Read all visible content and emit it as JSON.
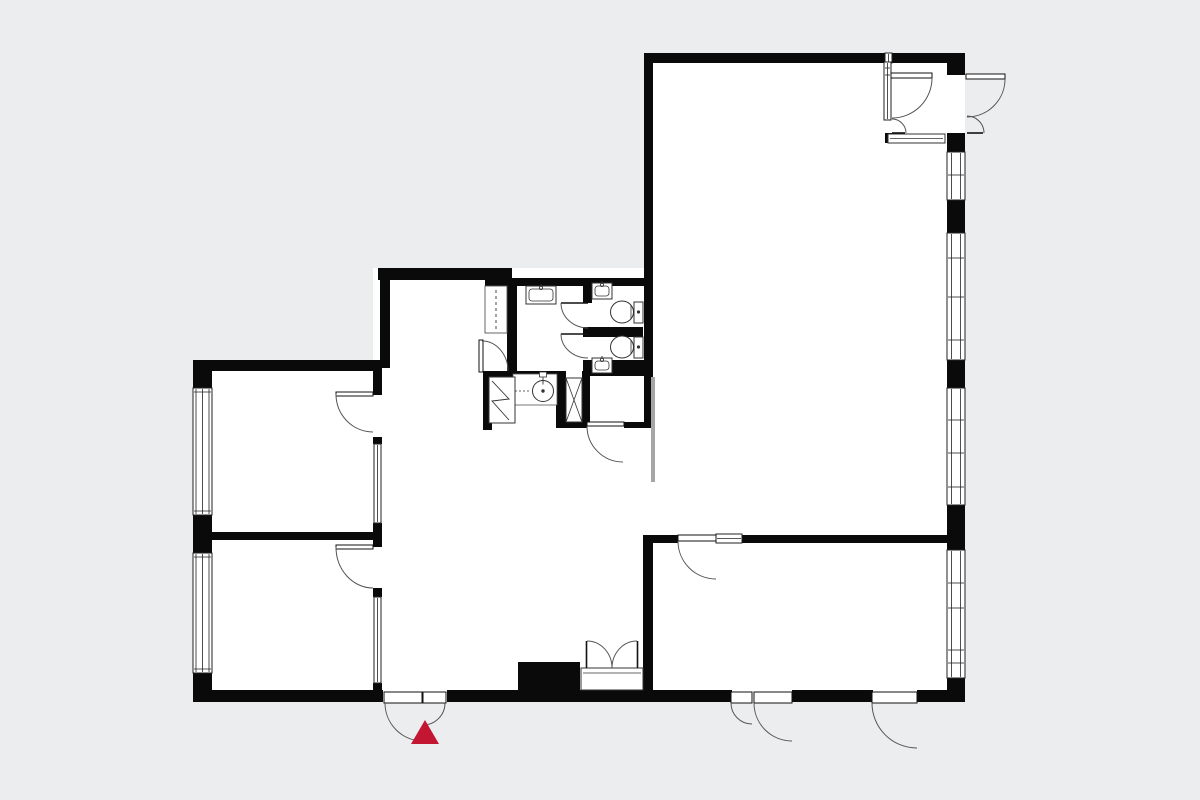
{
  "colors": {
    "background": "#ecedee",
    "floor": "#ffffff",
    "wall": "#0a0a0a",
    "outline": "#222222",
    "thin": "#555555",
    "arc": "#555555",
    "fixture": "#333333",
    "sliding_panel": "#a6a6a6",
    "accent_red": "#c31632"
  },
  "plan": {
    "floors": [
      {
        "n": "floor-main-room",
        "r": [
          644,
          53,
          321,
          649
        ]
      },
      {
        "n": "floor-middle-zone",
        "r": [
          373,
          268,
          280,
          434
        ]
      },
      {
        "n": "floor-left-rooms",
        "r": [
          193,
          360,
          189,
          342
        ]
      }
    ],
    "walls": [
      {
        "n": "wall-top-main-left",
        "r": [
          644,
          53,
          241,
          10
        ]
      },
      {
        "n": "wall-top-main-right",
        "r": [
          892,
          53,
          73,
          10
        ]
      },
      {
        "n": "wall-main-left",
        "r": [
          644,
          53,
          9,
          375
        ]
      },
      {
        "n": "wall-right-seg-1",
        "r": [
          947,
          53,
          18,
          22
        ]
      },
      {
        "n": "wall-right-seg-2",
        "r": [
          947,
          133,
          18,
          19
        ]
      },
      {
        "n": "wall-right-seg-3",
        "r": [
          947,
          200,
          18,
          33
        ]
      },
      {
        "n": "wall-right-seg-4",
        "r": [
          947,
          360,
          18,
          28
        ]
      },
      {
        "n": "wall-right-seg-5",
        "r": [
          947,
          505,
          18,
          45
        ]
      },
      {
        "n": "wall-right-seg-6",
        "r": [
          947,
          678,
          18,
          24
        ]
      },
      {
        "n": "wall-dining-top-left",
        "r": [
          643,
          535,
          35,
          8
        ]
      },
      {
        "n": "wall-dining-top-right",
        "r": [
          740,
          535,
          207,
          8
        ]
      },
      {
        "n": "wall-dining-left",
        "r": [
          643,
          543,
          10,
          147
        ]
      },
      {
        "n": "wall-bottom-seg-1",
        "r": [
          643,
          690,
          89,
          12
        ]
      },
      {
        "n": "wall-bottom-seg-2",
        "r": [
          792,
          690,
          81,
          12
        ]
      },
      {
        "n": "wall-bottom-seg-3",
        "r": [
          917,
          690,
          48,
          12
        ]
      },
      {
        "n": "wall-vestibule-nub",
        "r": [
          885,
          133,
          7,
          10
        ]
      },
      {
        "n": "wall-middle-top",
        "r": [
          378,
          268,
          134,
          12
        ]
      },
      {
        "n": "wall-middle-top-jog",
        "r": [
          485,
          268,
          27,
          18
        ]
      },
      {
        "n": "wall-bath-top-thin",
        "r": [
          505,
          278,
          148,
          8
        ]
      },
      {
        "n": "wall-middle-left-upper",
        "r": [
          380,
          268,
          10,
          100
        ]
      },
      {
        "n": "wall-bath1-left",
        "r": [
          507,
          286,
          10,
          85
        ]
      },
      {
        "n": "wall-wc-left-upper",
        "r": [
          583,
          280,
          9,
          23
        ]
      },
      {
        "n": "wall-wc-divider",
        "r": [
          583,
          327,
          60,
          10
        ]
      },
      {
        "n": "wall-below-wc",
        "r": [
          583,
          360,
          70,
          16
        ]
      },
      {
        "n": "wall-bath1-bottom",
        "r": [
          483,
          371,
          75,
          6
        ]
      },
      {
        "n": "wall-utility-left",
        "r": [
          483,
          371,
          9,
          59
        ]
      },
      {
        "n": "wall-shaft-left",
        "r": [
          556,
          371,
          10,
          57
        ]
      },
      {
        "n": "wall-shaft-right",
        "r": [
          582,
          371,
          8,
          51
        ]
      },
      {
        "n": "wall-hall-bottom-left",
        "r": [
          556,
          422,
          31,
          6
        ]
      },
      {
        "n": "wall-hall-bottom-right",
        "r": [
          624,
          422,
          29,
          6
        ]
      },
      {
        "n": "wall-bottom-middle",
        "r": [
          447,
          690,
          196,
          12
        ]
      },
      {
        "n": "wall-entrance-jamb",
        "r": [
          373,
          690,
          10,
          12
        ]
      },
      {
        "n": "chimney-block",
        "r": [
          518,
          662,
          62,
          28
        ]
      },
      {
        "n": "wall-leftrooms-top",
        "r": [
          193,
          360,
          189,
          11
        ]
      },
      {
        "n": "wall-leftrooms-divider",
        "r": [
          193,
          532,
          189,
          8
        ]
      },
      {
        "n": "wall-leftrooms-bottom",
        "r": [
          193,
          690,
          189,
          12
        ]
      },
      {
        "n": "wall-left-seg-1",
        "r": [
          193,
          360,
          19,
          28
        ]
      },
      {
        "n": "wall-left-seg-2",
        "r": [
          193,
          515,
          19,
          38
        ]
      },
      {
        "n": "wall-left-seg-3",
        "r": [
          193,
          673,
          19,
          29
        ]
      },
      {
        "n": "wall-leftrooms-right-1",
        "r": [
          373,
          371,
          9,
          24
        ]
      },
      {
        "n": "wall-leftrooms-right-2",
        "r": [
          373,
          437,
          9,
          7
        ]
      },
      {
        "n": "wall-leftrooms-right-3",
        "r": [
          373,
          523,
          9,
          24
        ]
      },
      {
        "n": "wall-leftrooms-right-4",
        "r": [
          373,
          588,
          9,
          9
        ]
      },
      {
        "n": "wall-leftrooms-right-5",
        "r": [
          373,
          683,
          9,
          19
        ]
      }
    ],
    "windows": [
      {
        "n": "window-left-top",
        "r": [
          193,
          388,
          19,
          127
        ],
        "v": [
          3,
          9.5,
          16
        ],
        "h": [
          392,
          511
        ]
      },
      {
        "n": "window-left-bottom",
        "r": [
          193,
          553,
          19,
          120
        ],
        "v": [
          3,
          9.5,
          16
        ],
        "h": [
          557,
          669
        ]
      },
      {
        "n": "window-right-1",
        "r": [
          947,
          152,
          18,
          48
        ],
        "v": [
          4.5,
          13.5
        ],
        "h": [
          175
        ]
      },
      {
        "n": "window-right-2",
        "r": [
          947,
          233,
          18,
          127
        ],
        "v": [
          4.5,
          13.5
        ],
        "h": [
          258,
          297,
          340
        ]
      },
      {
        "n": "window-right-3",
        "r": [
          947,
          388,
          18,
          117
        ],
        "v": [
          4.5,
          13.5
        ],
        "h": [
          420,
          453,
          487
        ]
      },
      {
        "n": "window-right-4",
        "r": [
          947,
          550,
          18,
          128
        ],
        "v": [
          4.5,
          13.5
        ],
        "h": [
          583,
          608,
          650,
          663
        ]
      },
      {
        "n": "window-transom-dining",
        "r": [
          716,
          534,
          26,
          9
        ],
        "v": [],
        "h": [
          538.5
        ]
      },
      {
        "n": "window-top-sliver",
        "r": [
          885,
          53,
          7,
          10
        ],
        "v": [
          3.5
        ],
        "h": []
      },
      {
        "n": "partition-glazed-top",
        "r": [
          374,
          444,
          7,
          79
        ],
        "v": [
          3.5
        ],
        "h": []
      },
      {
        "n": "partition-glazed-bottom",
        "r": [
          374,
          597,
          7,
          86
        ],
        "v": [
          3.5
        ],
        "h": []
      },
      {
        "n": "partition-vestibule",
        "r": [
          884,
          62,
          7,
          58
        ],
        "v": [
          3.5
        ],
        "h": [
          68,
          75
        ]
      }
    ],
    "doors": [
      {
        "n": "door-main-entrance-big",
        "leaf": {
          "rect": [
            384,
            692,
            38,
            11
          ]
        },
        "arc": "M385,703 A38,38 0 0 0 423,741"
      },
      {
        "n": "door-main-entrance-small",
        "leaf": {
          "rect": [
            423,
            692,
            23,
            11
          ]
        },
        "arc": "M445,703 A22,22 0 0 1 423,725"
      },
      {
        "n": "door-terrace1-small",
        "leaf": {
          "rect": [
            731,
            692,
            21,
            11
          ]
        },
        "arc": "M731,703 A21,21 0 0 0 752,724"
      },
      {
        "n": "door-terrace1-big",
        "leaf": {
          "rect": [
            754,
            692,
            38,
            11
          ]
        },
        "arc": "M754,703 A38,38 0 0 0 792,741"
      },
      {
        "n": "door-terrace2",
        "leaf": {
          "rect": [
            872,
            692,
            45,
            11
          ]
        },
        "arc": "M872,703 A45,45 0 0 0 917,748"
      },
      {
        "n": "door-side-entrance-big",
        "leaf": {
          "rect": [
            966,
            74,
            39,
            5
          ]
        },
        "arc": "M1005,79 A38,38 0 0 1 967,117"
      },
      {
        "n": "door-side-entrance-small",
        "leaf": {
          "line": [
            967,
            133,
            983,
            133
          ]
        },
        "arc": "M984,133 A17,17 0 0 0 967,116"
      },
      {
        "n": "door-vestibule-big",
        "leaf": {
          "rect": [
            891,
            73,
            41,
            5
          ]
        },
        "arc": "M932,78 A40,40 0 0 1 892,118"
      },
      {
        "n": "door-vestibule-small",
        "leaf": {
          "line": [
            892,
            133,
            905,
            133
          ]
        },
        "arc": "M906,133 A14,14 0 0 0 892,119"
      },
      {
        "n": "door-left-room-top",
        "leaf": {
          "rect": [
            336,
            392,
            37,
            4
          ]
        },
        "arc": "M336,394 A37,38 0 0 0 373,432"
      },
      {
        "n": "door-left-room-bottom",
        "leaf": {
          "rect": [
            336,
            545,
            37,
            4
          ]
        },
        "arc": "M336,547 A37,41 0 0 0 373,588"
      },
      {
        "n": "door-utility",
        "leaf": {
          "rect": [
            479,
            340,
            4,
            32
          ]
        },
        "arc": "M482,341 A26,30 0 0 1 508,371"
      },
      {
        "n": "door-wc1",
        "leaf": {
          "line": [
            561,
            303,
            588,
            303
          ]
        },
        "arc": "M561,303 A27,25 0 0 0 588,328"
      },
      {
        "n": "door-wc2",
        "leaf": {
          "line": [
            561,
            334,
            588,
            334
          ]
        },
        "arc": "M561,334 A27,24 0 0 0 588,358"
      },
      {
        "n": "door-hall",
        "leaf": {
          "rect": [
            587,
            422,
            37,
            4
          ]
        },
        "arc": "M587,426 A36,36 0 0 0 623,462"
      },
      {
        "n": "door-dining",
        "leaf": {
          "rect": [
            678,
            535,
            38,
            6
          ]
        },
        "arc": "M678,541 A38,38 0 0 0 716,579"
      },
      {
        "n": "door-cupboard-left",
        "leaf": {
          "line": [
            586.5,
            641,
            586.5,
            668
          ]
        },
        "arc": "M587,641 A25,27 0 0 1 612,668"
      },
      {
        "n": "door-cupboard-right",
        "leaf": {
          "line": [
            637.5,
            641,
            637.5,
            668
          ]
        },
        "arc": "M637,641 A25,27 0 0 0 612,668"
      }
    ],
    "fixtures": [
      {
        "t": "toilet",
        "n": "toilet-1",
        "bowl": [
          622,
          312,
          11.5,
          11
        ],
        "tank": [
          634,
          302,
          9,
          21
        ],
        "chord": [
          631,
          305,
          631,
          319
        ],
        "dot": [
          638.5,
          312
        ]
      },
      {
        "t": "toilet",
        "n": "toilet-2",
        "bowl": [
          622,
          347,
          11.5,
          11
        ],
        "tank": [
          634,
          337,
          9,
          21
        ],
        "chord": [
          631,
          340,
          631,
          354
        ],
        "dot": [
          638.5,
          347
        ]
      },
      {
        "t": "sink",
        "n": "sink-wc1",
        "outer": [
          592,
          283,
          20,
          16
        ],
        "inner": [
          595,
          286,
          14,
          10
        ],
        "tap": [
          602,
          285
        ]
      },
      {
        "t": "sink",
        "n": "sink-wc2",
        "outer": [
          592,
          358,
          20,
          15
        ],
        "inner": [
          595,
          361,
          14,
          9
        ],
        "tap": [
          602,
          360
        ]
      },
      {
        "t": "sink",
        "n": "sink-bathroom",
        "outer": [
          526,
          286,
          30,
          18
        ],
        "inner": [
          529,
          289,
          24,
          12
        ],
        "tap": [
          541,
          288
        ]
      },
      {
        "t": "basin",
        "n": "laundry-basin",
        "counter": [
          513,
          374,
          44,
          31
        ],
        "circle": [
          543,
          391,
          10.5
        ],
        "tap": [
          539.5,
          372,
          7,
          5
        ],
        "dash": [
          515,
          391,
          531,
          391
        ]
      },
      {
        "t": "washer",
        "n": "washing-machine",
        "r": [
          489,
          377,
          26,
          46
        ],
        "zig": "M492,381 L509,399 L492,401 L509,420"
      },
      {
        "t": "closet",
        "n": "wardrobe-dashed",
        "r": [
          485,
          286,
          22,
          47
        ],
        "dash": [
          496,
          290,
          496,
          330
        ]
      },
      {
        "t": "shaft",
        "n": "duct-shaft",
        "r": [
          566,
          378,
          16,
          44
        ]
      },
      {
        "t": "cabinet",
        "n": "vestibule-cabinet",
        "r": [
          888,
          134,
          57,
          9
        ],
        "line": [
          890,
          138.5,
          943,
          138.5
        ]
      },
      {
        "t": "cabinet",
        "n": "cupboard-body",
        "r": [
          581,
          668,
          62,
          22
        ],
        "line": [
          583,
          673,
          641,
          673
        ]
      },
      {
        "t": "panel",
        "n": "sliding-door-panel",
        "r": [
          651,
          377,
          4,
          105
        ]
      }
    ],
    "entrance_marker": {
      "n": "entrance-marker-triangle",
      "points": "425,720 411,744 439,744"
    }
  }
}
